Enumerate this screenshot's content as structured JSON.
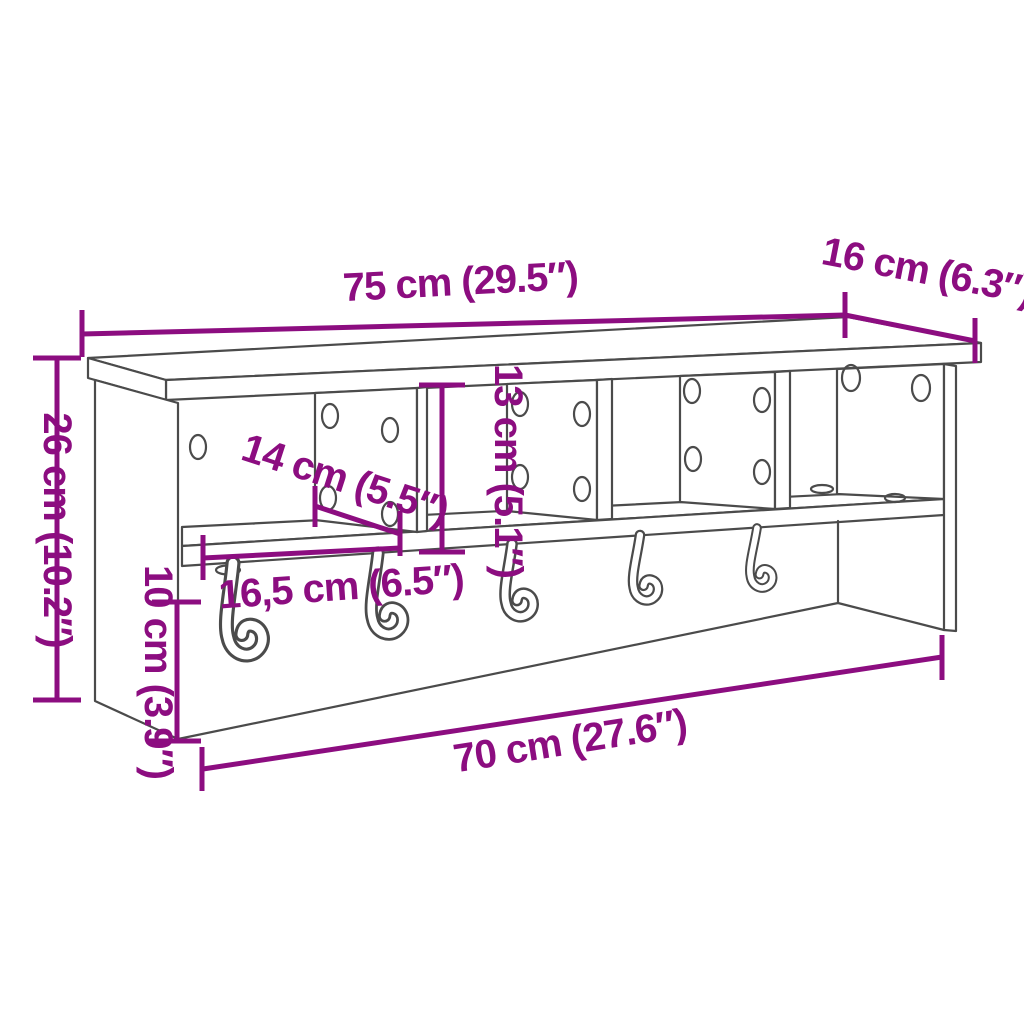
{
  "diagram": {
    "type": "furniture-dimension-diagram",
    "product": "Wall-mounted coat rack with shelf, 4 compartments and 5 hooks",
    "style": "line drawing with purple dimension annotations",
    "colors": {
      "accent": "#8C0D80",
      "outline": "#4B4B4B",
      "background": "#FFFFFF"
    },
    "compartment_count": 4,
    "hook_count": 5,
    "dimensions": {
      "total_width": {
        "label": "75 cm (29.5″)",
        "cm": 75,
        "inches": 29.5,
        "orientation": "horizontal-top"
      },
      "depth": {
        "label": "16 cm (6.3″)",
        "cm": 16,
        "inches": 6.3,
        "orientation": "diagonal-top-right"
      },
      "total_height": {
        "label": "26 cm (10.2″)",
        "cm": 26,
        "inches": 10.2,
        "orientation": "vertical-left"
      },
      "compartment_height": {
        "label": "13 cm (5.1″)",
        "cm": 13,
        "inches": 5.1,
        "orientation": "vertical-middle"
      },
      "compartment_depth": {
        "label": "14 cm (5.5″)",
        "cm": 14,
        "inches": 5.5,
        "orientation": "diagonal-middle"
      },
      "compartment_width": {
        "label": "16,5 cm (6.5″)",
        "cm": 16.5,
        "inches": 6.5,
        "orientation": "horizontal-middle"
      },
      "rail_height": {
        "label": "10 cm (3.9″)",
        "cm": 10,
        "inches": 3.9,
        "orientation": "vertical-lower-left"
      },
      "bottom_width": {
        "label": "70 cm (27.6″)",
        "cm": 70,
        "inches": 27.6,
        "orientation": "diagonal-bottom"
      }
    }
  }
}
